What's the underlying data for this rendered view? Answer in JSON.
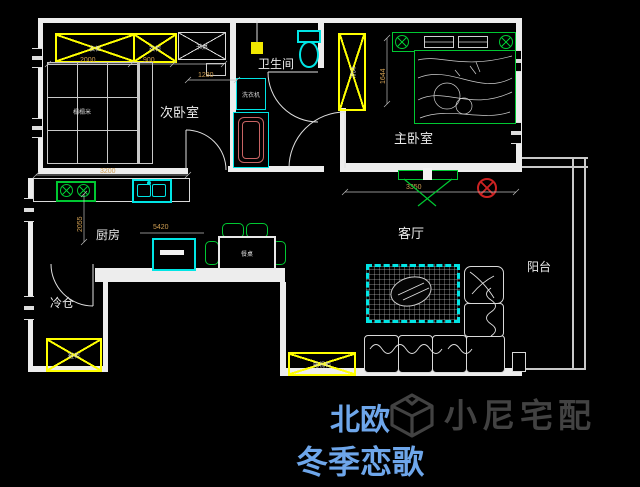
{
  "title": {
    "line1": "北欧",
    "line2": "冬季恋歌"
  },
  "watermark": {
    "brand": "小尼宅配"
  },
  "rooms": {
    "secondary_bedroom": "次卧室",
    "bathroom": "卫生间",
    "master_bedroom": "主卧室",
    "kitchen": "厨房",
    "cold_storage": "冷仓",
    "living_room": "客厅",
    "balcony": "阳台"
  },
  "furniture": {
    "wardrobe_a": "衣柜",
    "wardrobe_b": "衣柜",
    "master_wardrobe": "衣柜",
    "desk": "书桌",
    "tatami": "榻榻米",
    "washing_machine": "洗衣机",
    "dining_table": "餐桌",
    "shoe_cabinet": "鞋柜",
    "tv_cabinet": "电视柜"
  },
  "dimensions": {
    "wardrobe_a": "2000",
    "wardrobe_b": "900",
    "desk": "1280",
    "kitchen_run": "3200",
    "kitchen_depth": "2055",
    "dining_run": "5420",
    "master_depth": "1644",
    "living_run": "3350"
  },
  "colors": {
    "background": "#000000",
    "wall": "#ededed",
    "cabinet_yellow": "#ffff00",
    "fixture_cyan": "#00e5e5",
    "furniture_green": "#00c832",
    "dimension_text": "#cf9e52",
    "title_blue": "#6ea6ea",
    "watermark_gray": "#4a4a4a",
    "lamp_red": "#cc2222",
    "bathtub_red": "#c86464"
  }
}
